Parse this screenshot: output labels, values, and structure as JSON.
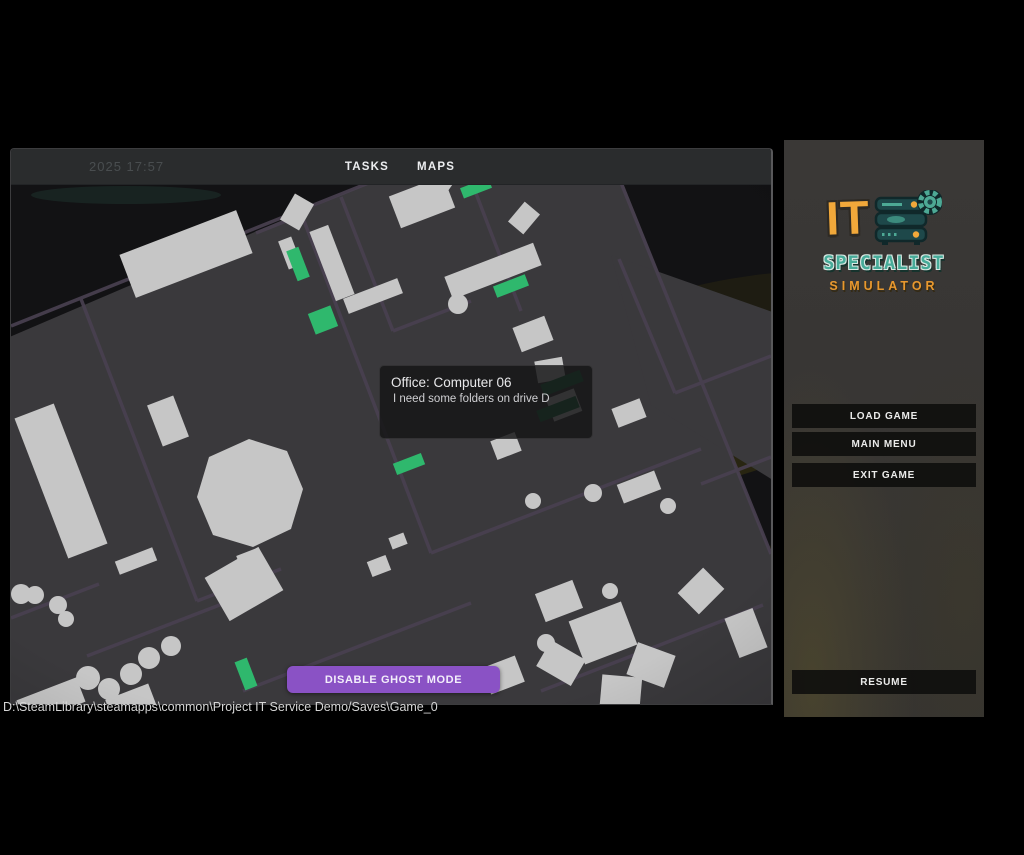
{
  "window": {
    "datetime": "2025  17:57",
    "tabs": [
      {
        "label": "TASKS"
      },
      {
        "label": "MAPS"
      }
    ],
    "tooltip": {
      "title": "Office: Computer 06",
      "description": "I need some folders on drive D"
    },
    "ghost_button_label": "DISABLE GHOST MODE",
    "path_text": "D:\\SteamLibrary\\steamapps\\common\\Project IT Service Demo/Saves\\Game_0"
  },
  "menu": {
    "logo": {
      "line1": "IT",
      "line2": "SPECIALIST",
      "line3": "SIMULATOR",
      "icon": "server-rack-gear-icon"
    },
    "buttons": [
      {
        "label": "LOAD GAME"
      },
      {
        "label": "MAIN MENU"
      },
      {
        "label": "EXIT GAME"
      }
    ],
    "resume_label": "RESUME"
  },
  "colors": {
    "accent_purple": "#8a52c5",
    "task_green": "#2fb86d",
    "task_green_dim": "#1d6b40",
    "map_floor": "#3a393c",
    "map_wall": "#494050",
    "furniture": "#c6c6c6",
    "logo_orange": "#f1a83a",
    "logo_teal": "#47ab99",
    "panel_bg": "#383634",
    "header_bg": "#2a2c2d"
  }
}
